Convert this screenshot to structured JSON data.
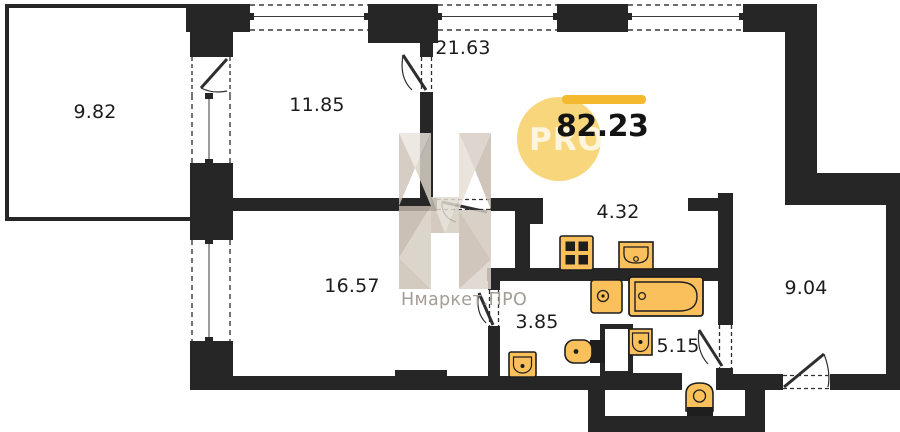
{
  "plan": {
    "total_area": "82.23",
    "watermark": {
      "brand": "Нмаркет.ПРО",
      "logo_text": "PRO"
    },
    "rooms": [
      {
        "name": "balcony",
        "area": "9.82"
      },
      {
        "name": "bedroom-1",
        "area": "11.85"
      },
      {
        "name": "living",
        "area": "21.63"
      },
      {
        "name": "bedroom-2",
        "area": "16.57"
      },
      {
        "name": "kitchen",
        "area": "4.32"
      },
      {
        "name": "wc",
        "area": "3.85"
      },
      {
        "name": "bathroom",
        "area": "5.15"
      },
      {
        "name": "hall",
        "area": "9.04"
      }
    ],
    "colors": {
      "wall": "#262626",
      "fixture": "#f9c05c",
      "logo_circle": "#f8d77c",
      "logo_bar": "#f3ba2f",
      "watermark_text": "#a49d95"
    }
  }
}
